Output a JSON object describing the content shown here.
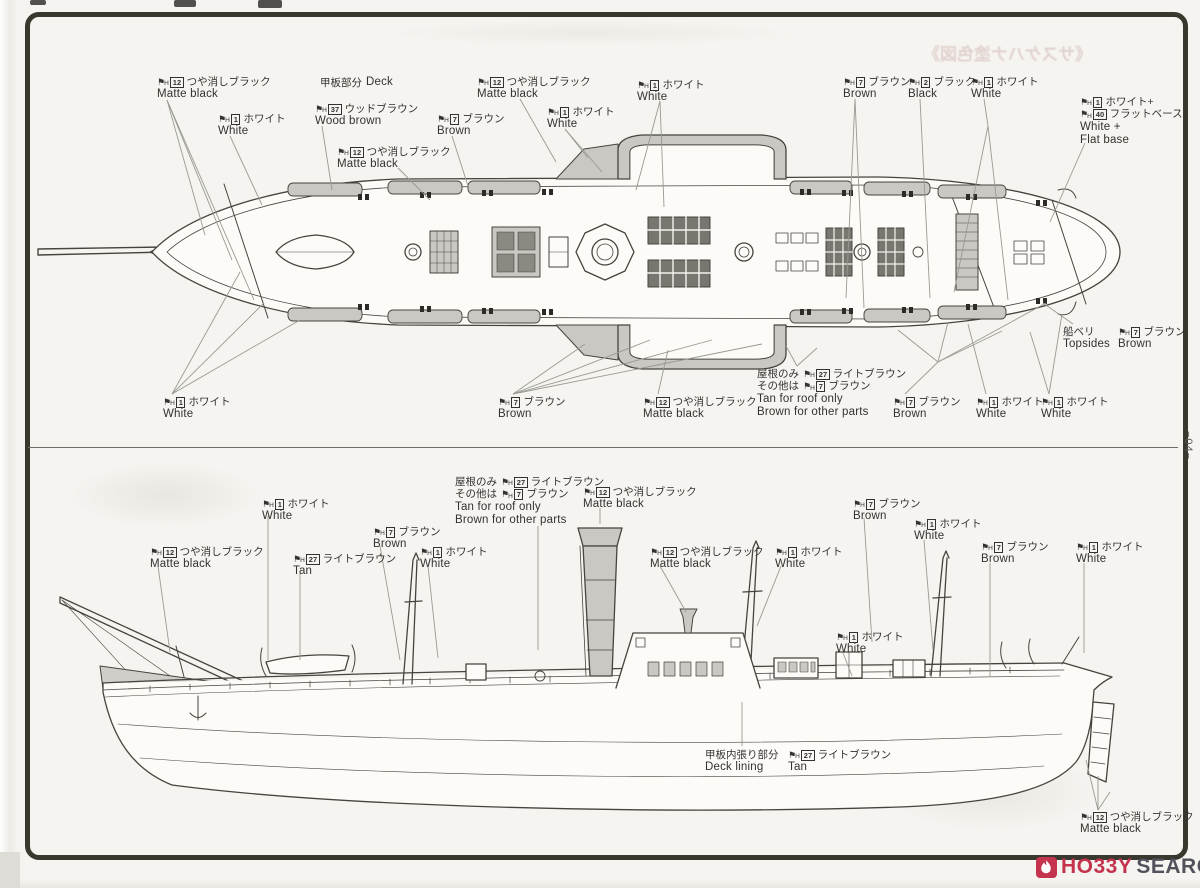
{
  "page": {
    "number": "−04−",
    "bleedthrough_title": "《サスケハナ塗色図》"
  },
  "watermark": {
    "hobby": "HO33Y",
    "search": "SEARCH",
    "red": "#c5344e",
    "dark": "#53525c"
  },
  "palette": {
    "paper": "#f5f4f0",
    "ink": "#45443f",
    "gray_fill": "#c9c8c3",
    "dark_fill": "#77766f",
    "frame": "#39382f"
  },
  "callouts": [
    {
      "x": 157,
      "y": 76,
      "lines": [
        {
          "code": "12",
          "jp": "つや消しブラック"
        },
        {
          "en": "Matte black"
        }
      ]
    },
    {
      "x": 218,
      "y": 113,
      "lines": [
        {
          "code": "1",
          "jp": "ホワイト"
        },
        {
          "en": "White"
        }
      ]
    },
    {
      "x": 320,
      "y": 76,
      "lines": [
        {
          "pre": "甲板部分",
          "en": "Deck"
        }
      ]
    },
    {
      "x": 315,
      "y": 103,
      "lines": [
        {
          "code": "37",
          "jp": "ウッドブラウン"
        },
        {
          "en": "Wood brown"
        }
      ]
    },
    {
      "x": 337,
      "y": 146,
      "lines": [
        {
          "code": "12",
          "jp": "つや消しブラック"
        },
        {
          "en": "Matte black"
        }
      ]
    },
    {
      "x": 437,
      "y": 113,
      "lines": [
        {
          "code": "7",
          "jp": "ブラウン"
        },
        {
          "en": "Brown"
        }
      ]
    },
    {
      "x": 477,
      "y": 76,
      "lines": [
        {
          "code": "12",
          "jp": "つや消しブラック"
        },
        {
          "en": "Matte black"
        }
      ]
    },
    {
      "x": 547,
      "y": 106,
      "lines": [
        {
          "code": "1",
          "jp": "ホワイト"
        },
        {
          "en": "White"
        }
      ]
    },
    {
      "x": 637,
      "y": 79,
      "lines": [
        {
          "code": "1",
          "jp": "ホワイト"
        },
        {
          "en": "White"
        }
      ]
    },
    {
      "x": 843,
      "y": 76,
      "lines": [
        {
          "code": "7",
          "jp": "ブラウン"
        },
        {
          "en": "Brown"
        }
      ]
    },
    {
      "x": 908,
      "y": 76,
      "lines": [
        {
          "code": "2",
          "jp": "ブラック"
        },
        {
          "en": "Black"
        }
      ]
    },
    {
      "x": 971,
      "y": 76,
      "lines": [
        {
          "code": "1",
          "jp": "ホワイト"
        },
        {
          "en": "White"
        }
      ]
    },
    {
      "x": 1080,
      "y": 96,
      "lines": [
        {
          "code": "1",
          "jp": "ホワイト+"
        },
        {
          "code": "40",
          "jp": "フラットベース"
        },
        {
          "en": "White +"
        },
        {
          "en": "Flat base"
        }
      ]
    },
    {
      "x": 1063,
      "y": 326,
      "lines": [
        {
          "pre": "船ベリ"
        },
        {
          "en": "Topsides"
        }
      ]
    },
    {
      "x": 1118,
      "y": 326,
      "lines": [
        {
          "code": "7",
          "jp": "ブラウン"
        },
        {
          "en": "Brown"
        }
      ]
    },
    {
      "x": 163,
      "y": 396,
      "lines": [
        {
          "code": "1",
          "jp": "ホワイト"
        },
        {
          "en": "White"
        }
      ]
    },
    {
      "x": 498,
      "y": 396,
      "lines": [
        {
          "code": "7",
          "jp": "ブラウン"
        },
        {
          "en": "Brown"
        }
      ]
    },
    {
      "x": 643,
      "y": 396,
      "lines": [
        {
          "code": "12",
          "jp": "つや消しブラック"
        },
        {
          "en": "Matte black"
        }
      ]
    },
    {
      "x": 757,
      "y": 368,
      "lines": [
        {
          "pre": "屋根のみ",
          "code": "27",
          "jp": "ライトブラウン"
        },
        {
          "pre": "その他は",
          "code": "7",
          "jp": "ブラウン"
        },
        {
          "en": "Tan for roof only"
        },
        {
          "en": "Brown for other parts"
        }
      ]
    },
    {
      "x": 893,
      "y": 396,
      "lines": [
        {
          "code": "7",
          "jp": "ブラウン"
        },
        {
          "en": "Brown"
        }
      ]
    },
    {
      "x": 976,
      "y": 396,
      "lines": [
        {
          "code": "1",
          "jp": "ホワイト"
        },
        {
          "en": "White"
        }
      ]
    },
    {
      "x": 1041,
      "y": 396,
      "lines": [
        {
          "code": "1",
          "jp": "ホワイト"
        },
        {
          "en": "White"
        }
      ]
    },
    {
      "x": 455,
      "y": 476,
      "lines": [
        {
          "pre": "屋根のみ",
          "code": "27",
          "jp": "ライトブラウン"
        },
        {
          "pre": "その他は",
          "code": "7",
          "jp": "ブラウン"
        },
        {
          "en": "Tan for roof only"
        },
        {
          "en": "Brown for other parts"
        }
      ]
    },
    {
      "x": 583,
      "y": 486,
      "lines": [
        {
          "code": "12",
          "jp": "つや消しブラック"
        },
        {
          "en": "Matte black"
        }
      ]
    },
    {
      "x": 262,
      "y": 498,
      "lines": [
        {
          "code": "1",
          "jp": "ホワイト"
        },
        {
          "en": "White"
        }
      ]
    },
    {
      "x": 373,
      "y": 526,
      "lines": [
        {
          "code": "7",
          "jp": "ブラウン"
        },
        {
          "en": "Brown"
        }
      ]
    },
    {
      "x": 150,
      "y": 546,
      "lines": [
        {
          "code": "12",
          "jp": "つや消しブラック"
        },
        {
          "en": "Matte black"
        }
      ]
    },
    {
      "x": 293,
      "y": 553,
      "lines": [
        {
          "code": "27",
          "jp": "ライトブラウン"
        },
        {
          "en": "Tan"
        }
      ]
    },
    {
      "x": 420,
      "y": 546,
      "lines": [
        {
          "code": "1",
          "jp": "ホワイト"
        },
        {
          "en": "White"
        }
      ]
    },
    {
      "x": 650,
      "y": 546,
      "lines": [
        {
          "code": "12",
          "jp": "つや消しブラック"
        },
        {
          "en": "Matte black"
        }
      ]
    },
    {
      "x": 775,
      "y": 546,
      "lines": [
        {
          "code": "1",
          "jp": "ホワイト"
        },
        {
          "en": "White"
        }
      ]
    },
    {
      "x": 853,
      "y": 498,
      "lines": [
        {
          "code": "7",
          "jp": "ブラウン"
        },
        {
          "en": "Brown"
        }
      ]
    },
    {
      "x": 914,
      "y": 518,
      "lines": [
        {
          "code": "1",
          "jp": "ホワイト"
        },
        {
          "en": "White"
        }
      ]
    },
    {
      "x": 836,
      "y": 631,
      "lines": [
        {
          "code": "1",
          "jp": "ホワイト"
        },
        {
          "en": "White"
        }
      ]
    },
    {
      "x": 981,
      "y": 541,
      "lines": [
        {
          "code": "7",
          "jp": "ブラウン"
        },
        {
          "en": "Brown"
        }
      ]
    },
    {
      "x": 1076,
      "y": 541,
      "lines": [
        {
          "code": "1",
          "jp": "ホワイト"
        },
        {
          "en": "White"
        }
      ]
    },
    {
      "x": 705,
      "y": 749,
      "lines": [
        {
          "pre": "甲板内張り部分"
        },
        {
          "en": "Deck lining"
        }
      ]
    },
    {
      "x": 788,
      "y": 749,
      "lines": [
        {
          "code": "27",
          "jp": "ライトブラウン"
        },
        {
          "en": "Tan"
        }
      ]
    },
    {
      "x": 1080,
      "y": 811,
      "lines": [
        {
          "code": "12",
          "jp": "つや消しブラック"
        },
        {
          "en": "Matte black"
        }
      ]
    }
  ],
  "leader_lines": [
    [
      167,
      100,
      205,
      235
    ],
    [
      167,
      100,
      232,
      260
    ],
    [
      167,
      100,
      254,
      300
    ],
    [
      230,
      136,
      262,
      205
    ],
    [
      322,
      126,
      332,
      190
    ],
    [
      398,
      168,
      430,
      200
    ],
    [
      452,
      136,
      468,
      186
    ],
    [
      520,
      99,
      556,
      162
    ],
    [
      565,
      129,
      588,
      158
    ],
    [
      565,
      129,
      602,
      172
    ],
    [
      660,
      101,
      636,
      190
    ],
    [
      660,
      101,
      664,
      207
    ],
    [
      855,
      99,
      846,
      298
    ],
    [
      855,
      99,
      864,
      308
    ],
    [
      920,
      99,
      930,
      298
    ],
    [
      984,
      99,
      988,
      126
    ],
    [
      988,
      126,
      954,
      292
    ],
    [
      988,
      126,
      1008,
      300
    ],
    [
      1085,
      143,
      1050,
      222
    ],
    [
      1073,
      324,
      1043,
      303
    ],
    [
      172,
      394,
      240,
      272
    ],
    [
      172,
      394,
      264,
      303
    ],
    [
      172,
      394,
      300,
      320
    ],
    [
      513,
      394,
      585,
      344
    ],
    [
      513,
      394,
      650,
      340
    ],
    [
      513,
      394,
      712,
      340
    ],
    [
      513,
      394,
      762,
      344
    ],
    [
      658,
      394,
      668,
      350
    ],
    [
      797,
      366,
      786,
      346
    ],
    [
      797,
      366,
      817,
      348
    ],
    [
      938,
      362,
      905,
      394
    ],
    [
      938,
      362,
      898,
      330
    ],
    [
      938,
      362,
      948,
      322
    ],
    [
      938,
      362,
      1002,
      331
    ],
    [
      938,
      362,
      1046,
      303
    ],
    [
      986,
      394,
      968,
      324
    ],
    [
      1049,
      394,
      1030,
      332
    ],
    [
      1049,
      394,
      1062,
      314
    ],
    [
      538,
      526,
      538,
      650
    ],
    [
      600,
      508,
      600,
      524
    ],
    [
      268,
      516,
      268,
      660
    ],
    [
      380,
      546,
      400,
      660
    ],
    [
      158,
      566,
      170,
      652
    ],
    [
      300,
      573,
      300,
      660
    ],
    [
      428,
      566,
      438,
      658
    ],
    [
      660,
      566,
      686,
      612
    ],
    [
      781,
      566,
      757,
      626
    ],
    [
      864,
      518,
      872,
      642
    ],
    [
      924,
      540,
      933,
      650
    ],
    [
      843,
      653,
      852,
      676
    ],
    [
      990,
      563,
      990,
      676
    ],
    [
      1084,
      563,
      1084,
      653
    ],
    [
      742,
      746,
      742,
      702
    ],
    [
      1098,
      810,
      1086,
      760
    ],
    [
      1098,
      810,
      1098,
      776
    ],
    [
      1098,
      810,
      1110,
      792
    ]
  ]
}
